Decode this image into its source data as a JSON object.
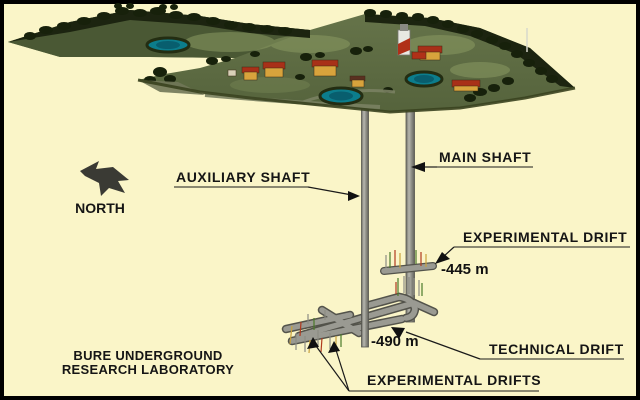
{
  "caption": {
    "line1": "BURE UNDERGROUND",
    "line2": "RESEARCH LABORATORY"
  },
  "compass": {
    "label": "NORTH"
  },
  "callouts": {
    "auxiliary_shaft": "AUXILIARY SHAFT",
    "main_shaft": "MAIN SHAFT",
    "experimental_drift": "EXPERIMENTAL DRIFT",
    "technical_drift": "TECHNICAL DRIFT",
    "experimental_drifts": "EXPERIMENTAL DRIFTS"
  },
  "depths": {
    "experimental_drift_level": "-445 m",
    "technical_drift_level": "-490 m"
  },
  "colors": {
    "background": "#FAF5C8",
    "border": "#000000",
    "label_text": "#151515",
    "shaft_gray": "#A3A39B",
    "tube_gray": "#9A9A92",
    "terrain_green": "#5E6C42",
    "tree_dark": "#1C2410",
    "pond_teal": "#0C7D8C",
    "roof_red": "#A83018",
    "wall_tan": "#D8A33C"
  }
}
